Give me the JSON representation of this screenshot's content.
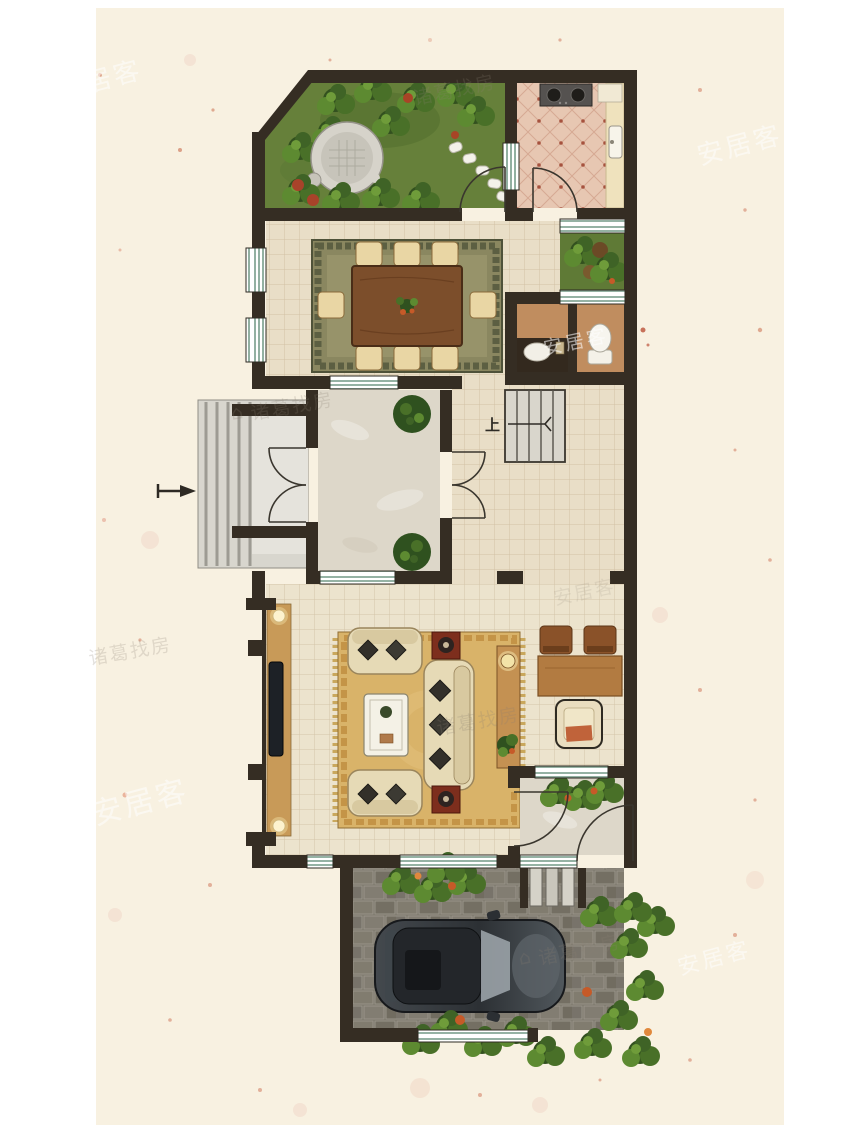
{
  "canvas": {
    "width": 850,
    "height": 1133,
    "background": "#ffffff",
    "paper_color": "#f8f1e1"
  },
  "floor_plan": {
    "stairs_label": "上",
    "watermarks": {
      "anjuke": "安居客",
      "zhuge": "诸葛找房",
      "zhuge_icon": "⌂"
    },
    "palette": {
      "wall": "#352d23",
      "tile_floor": "#e9dec7",
      "marble_floor": "#ddd7c9",
      "kitchen_tile": "#e7c7b2",
      "bath_floor": "#c08d5f",
      "grass": "#66803a",
      "dining_rug": "#8a8760",
      "living_rug": "#d9b369",
      "end_table_red": "#7d2e1d",
      "wood_furniture": "#b27b41",
      "window_stripe": "#86a897",
      "pavement": "#7b766a",
      "car_body": "#32373b",
      "speckle_red": "#c0512f"
    }
  }
}
